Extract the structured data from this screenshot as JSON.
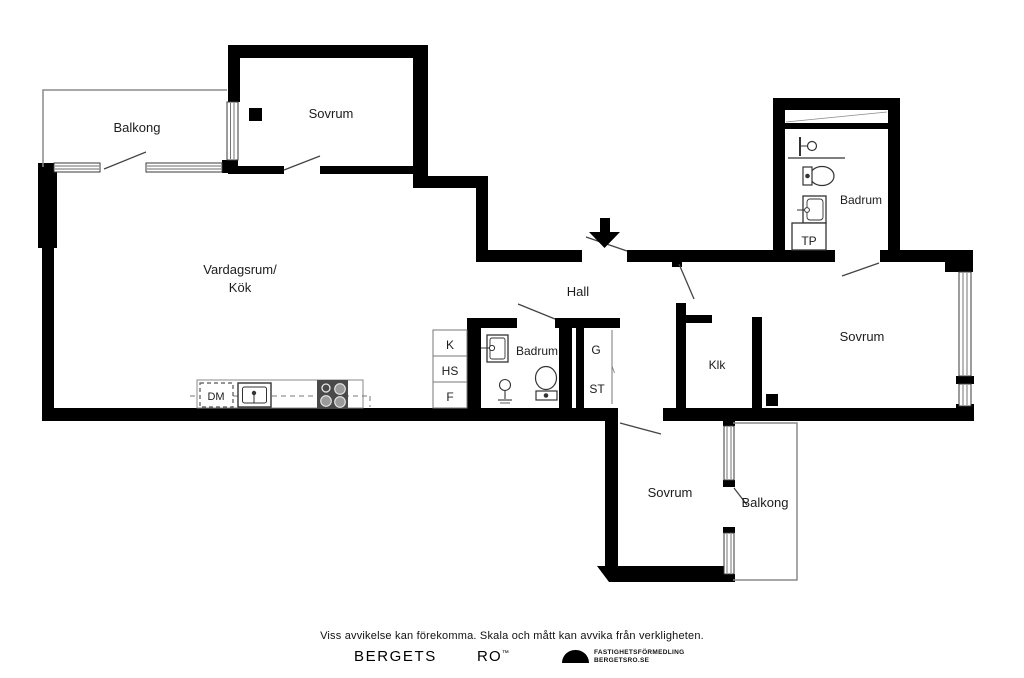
{
  "labels": {
    "balcony_top": "Balkong",
    "bedroom_top": "Sovrum",
    "living_line1": "Vardagsrum/",
    "living_line2": "Kök",
    "hall": "Hall",
    "bathroom_mid": "Badrum",
    "cabinet_k": "K",
    "cabinet_hs": "HS",
    "cabinet_f": "F",
    "closet_g": "G",
    "closet_st": "ST",
    "walkin_closet": "Klk",
    "bathroom_right": "Badrum",
    "laundry_tp": "TP",
    "bedroom_right": "Sovrum",
    "bedroom_bottom": "Sovrum",
    "balcony_bottom": "Balkong",
    "dishwasher_dm": "DM"
  },
  "footer": {
    "disclaimer": "Viss avvikelse kan förekomma. Skala och mått kan avvika från verkligheten.",
    "brand_word1": "BERGETS",
    "brand_word2": "RO",
    "trademark": "™",
    "agency_line1": "FASTIGHETSFÖRMEDLING",
    "agency_line2": "BERGETSRO.SE"
  },
  "colors": {
    "wall": "#000000",
    "background": "#ffffff",
    "thin_line": "#8a8a8a",
    "door_line": "#444444",
    "stove": "#4a4a4a"
  }
}
